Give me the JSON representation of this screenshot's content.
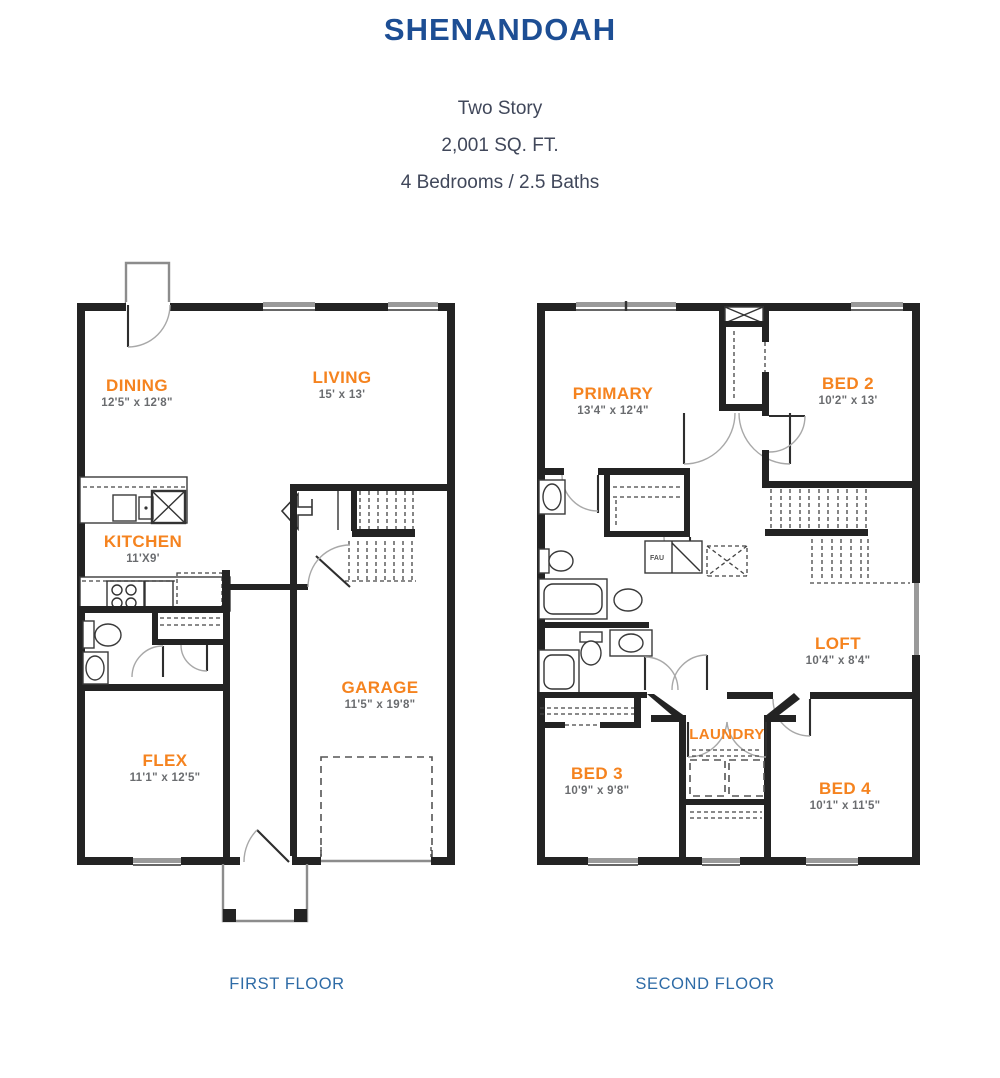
{
  "title": "SHENANDOAH",
  "subtitle": {
    "line1": "Two Story",
    "line2": "2,001 SQ. FT.",
    "line3": "4 Bedrooms / 2.5 Baths"
  },
  "colors": {
    "title_blue": "#1D4E94",
    "caption_blue": "#2E6BA6",
    "room_orange": "#F5831F",
    "dims_gray": "#6A6C6F",
    "wall_black": "#232323"
  },
  "floors": [
    {
      "caption": "FIRST FLOOR",
      "rooms": [
        {
          "name": "DINING",
          "dims": "12'5\" x 12'8\""
        },
        {
          "name": "LIVING",
          "dims": "15' x 13'"
        },
        {
          "name": "KITCHEN",
          "dims": "11'X9'"
        },
        {
          "name": "GARAGE",
          "dims": "11'5\" x 19'8\""
        },
        {
          "name": "FLEX",
          "dims": "11'1\" x 12'5\""
        }
      ]
    },
    {
      "caption": "SECOND FLOOR",
      "rooms": [
        {
          "name": "PRIMARY",
          "dims": "13'4\" x 12'4\""
        },
        {
          "name": "BED 2",
          "dims": "10'2\" x 13'"
        },
        {
          "name": "LOFT",
          "dims": "10'4\" x 8'4\""
        },
        {
          "name": "LAUNDRY",
          "dims": ""
        },
        {
          "name": "BED 3",
          "dims": "10'9\" x 9'8\""
        },
        {
          "name": "BED 4",
          "dims": "10'1\" x 11'5\""
        }
      ]
    }
  ],
  "fixtures": {
    "fau_label": "FAU"
  }
}
